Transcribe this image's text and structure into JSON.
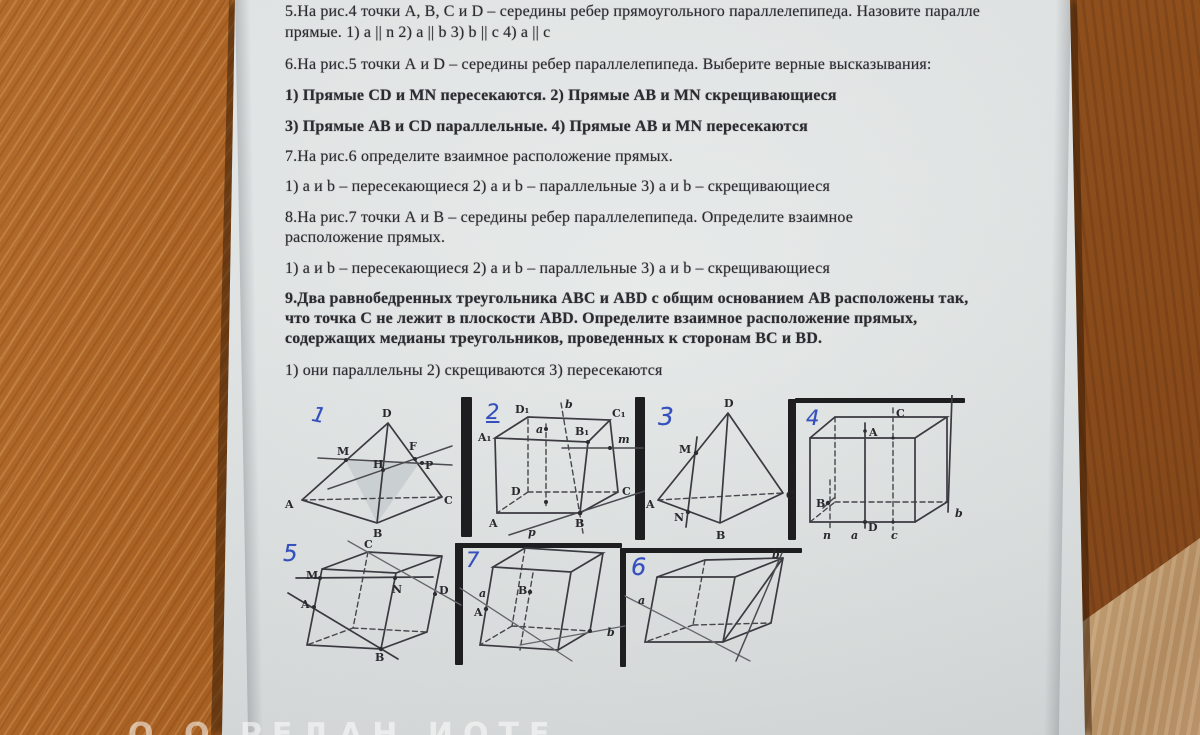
{
  "document": {
    "lines": [
      "5.На рис.4 точки А, В, С и D – середины ребер прямоугольного параллелепипеда. Назовите паралле",
      "прямые. 1) a || n 2) a || b 3) b || c 4) a || c",
      "6.На рис.5 точки А и D – середины ребер параллелепипеда. Выберите верные высказывания:",
      "1) Прямые CD и MN пересекаются. 2) Прямые АВ и MN скрещивающиеся",
      "3) Прямые АВ и CD параллельные. 4) Прямые АВ и MN пересекаются",
      "7.На рис.6 определите взаимное расположение прямых.",
      "1) a и b – пересекающиеся 2) a и b – параллельные 3) a и b – скрещивающиеся",
      "8.На рис.7 точки А и В – середины ребер параллелепипеда. Определите взаимное",
      "расположение прямых.",
      "1) a и b – пересекающиеся 2) a и b – параллельные 3) a и b – скрещивающиеся",
      "9.Два равнобедренных треугольника АВС и ABD с общим основанием АВ расположены так,",
      "что точка С не лежит в плоскости ABD. Определите взаимное расположение прямых,",
      "содержащих медианы треугольников, проведенных к сторонам ВС и BD.",
      "1) они параллельны 2) скрещиваются 3) пересекаются"
    ]
  },
  "figures": {
    "fig1": {
      "number": "1",
      "D": "D",
      "M": "M",
      "F": "F",
      "P": "P",
      "H": "H",
      "A": "A",
      "B": "B",
      "C": "C"
    },
    "fig2": {
      "number": "2",
      "A1": "A₁",
      "D1": "D₁",
      "B1": "B₁",
      "C1": "C₁",
      "A": "A",
      "B": "B",
      "C": "C",
      "D": "D",
      "a": "a",
      "b": "b",
      "m": "m",
      "p": "p"
    },
    "fig3": {
      "number": "3",
      "D": "D",
      "M": "M",
      "N": "N",
      "A": "A",
      "B": "B",
      "C": "C"
    },
    "fig4": {
      "number": "4",
      "A": "A",
      "B": "B",
      "C": "C",
      "D": "D",
      "a": "a",
      "b": "b",
      "c": "c",
      "n": "n"
    },
    "fig5": {
      "number": "5",
      "M": "M",
      "C": "C",
      "N": "N",
      "D": "D",
      "A": "A",
      "B": "B"
    },
    "fig7": {
      "number": "7",
      "A": "A",
      "B": "B",
      "a": "a",
      "b": "b"
    },
    "fig6": {
      "number": "6",
      "a": "a",
      "b": "b"
    }
  },
  "watermark": "О О РЕДАН ИОТЕ",
  "colors": {
    "ink_blue": "#3550bd",
    "paper": "#e4e8e6",
    "wood_left": "#a86226",
    "wood_right": "#8a4c1c",
    "wood_light_corner": "#bb9570",
    "pencil_dark": "#3a3a40"
  }
}
